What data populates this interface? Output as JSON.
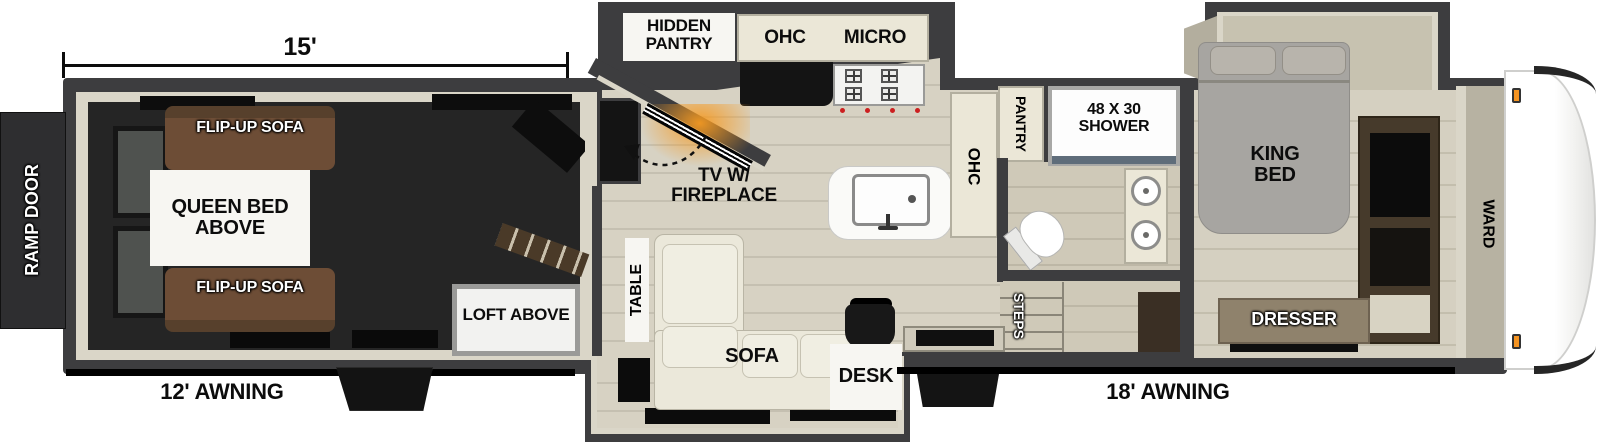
{
  "plan": {
    "garage": {
      "dimension": "15'",
      "ramp_door": "RAMP DOOR",
      "flip_up_sofa_top": "FLIP-UP SOFA",
      "flip_up_sofa_bottom": "FLIP-UP SOFA",
      "queen_bed": "QUEEN BED ABOVE",
      "loft": "LOFT ABOVE",
      "awning": "12' AWNING"
    },
    "kitchen": {
      "hidden_pantry": "HIDDEN PANTRY",
      "ohc": "OHC",
      "micro": "MICRO",
      "tv_fireplace": "TV W/ FIREPLACE",
      "island_ohc": "OHC",
      "pantry": "PANTRY"
    },
    "living": {
      "table": "TABLE",
      "sofa": "SOFA",
      "desk": "DESK",
      "steps": "STEPS",
      "awning": "18' AWNING"
    },
    "bathroom": {
      "shower": "48 X 30 SHOWER"
    },
    "bedroom": {
      "king_bed": "KING BED",
      "ward": "WARD",
      "dresser": "DRESSER"
    }
  },
  "colors": {
    "wall": "#3d3d3f",
    "lining": "#dad6c8",
    "garage_floor": "#252525",
    "wood_floor": "#d7d2c3",
    "bath_floor": "#cfc9b8",
    "cabinet_cream": "#ebe7d7",
    "counter_black": "#141414",
    "island_white": "#fafaf8",
    "sofa_cream": "#ebe8da",
    "flip_sofa_brown": "#6d4d36",
    "bed_gray": "#a7a5a1",
    "wardrobe_brown": "#463a2b",
    "dresser_tan": "#8f826c",
    "fireplace_glow": "#f59a22",
    "clearance_light": "#f59422",
    "awning_bar": "#000000",
    "ramp_door": "#2e2e30",
    "label_black": "#0c0c0c",
    "label_white": "#ffffff"
  }
}
